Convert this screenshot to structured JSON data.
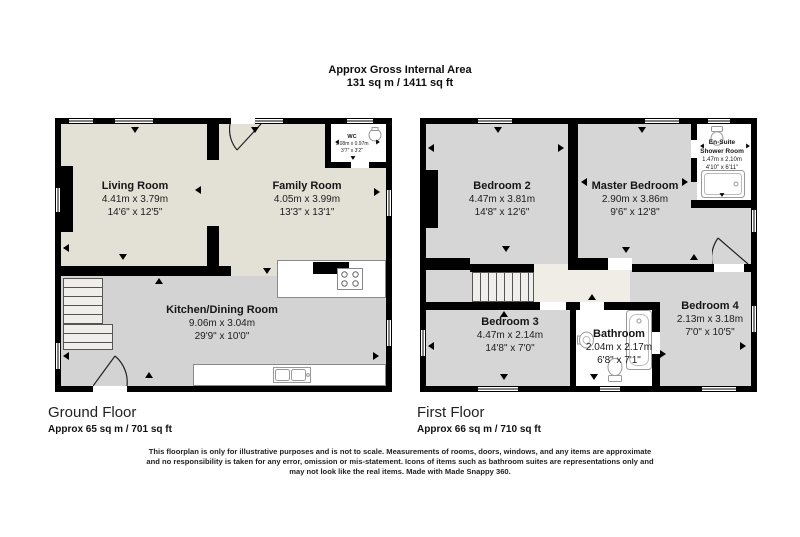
{
  "title": {
    "line1": "Approx Gross Internal Area",
    "line2": "131 sq m / 1411 sq ft"
  },
  "ground_floor": {
    "label": "Ground Floor",
    "area": "Approx 65 sq m / 701 sq ft",
    "rooms": {
      "living": {
        "name": "Living Room",
        "metric": "4.41m x 3.79m",
        "imperial": "14'6\" x 12'5\""
      },
      "family": {
        "name": "Family Room",
        "metric": "4.05m x 3.99m",
        "imperial": "13'3\" x 13'1\""
      },
      "kitchen": {
        "name": "Kitchen/Dining Room",
        "metric": "9.06m x 3.04m",
        "imperial": "29'9\" x 10'0\""
      },
      "wc": {
        "name": "WC",
        "metric": "1.08m x 0.97m",
        "imperial": "3'7\" x 3'2\""
      }
    }
  },
  "first_floor": {
    "label": "First Floor",
    "area": "Approx 66 sq m / 710 sq ft",
    "rooms": {
      "bedroom2": {
        "name": "Bedroom 2",
        "metric": "4.47m x 3.81m",
        "imperial": "14'8\" x 12'6\""
      },
      "master": {
        "name": "Master Bedroom",
        "metric": "2.90m x 3.86m",
        "imperial": "9'6\" x 12'8\""
      },
      "ensuite": {
        "name_line1": "En-Suite",
        "name_line2": "Shower Room",
        "metric": "1.47m x 2.10m",
        "imperial": "4'10\" x 6'11\""
      },
      "bedroom3": {
        "name": "Bedroom 3",
        "metric": "4.47m x 2.14m",
        "imperial": "14'8\" x 7'0\""
      },
      "bathroom": {
        "name": "Bathroom",
        "metric": "2.04m x 2.17m",
        "imperial": "6'8\" x 7'1\""
      },
      "bedroom4": {
        "name": "Bedroom 4",
        "metric": "2.13m x 3.18m",
        "imperial": "7'0\" x 10'5\""
      }
    }
  },
  "disclaimer": {
    "line1": "This floorplan is only for illustrative purposes and is not to scale. Measurements of rooms, doors, windows, and any items are approximate",
    "line2": "and no responsibility is taken for any error, omission or mis-statement. Icons of items such as bathroom suites are representations only and",
    "line3": "may not look like the real items. Made with Made Snappy 360."
  },
  "colors": {
    "wall": "#000000",
    "floor_beige": "#e3e0d6",
    "floor_gray": "#d3d3d3",
    "floor_light": "#f0ede6",
    "fixture_stroke": "#999999"
  }
}
